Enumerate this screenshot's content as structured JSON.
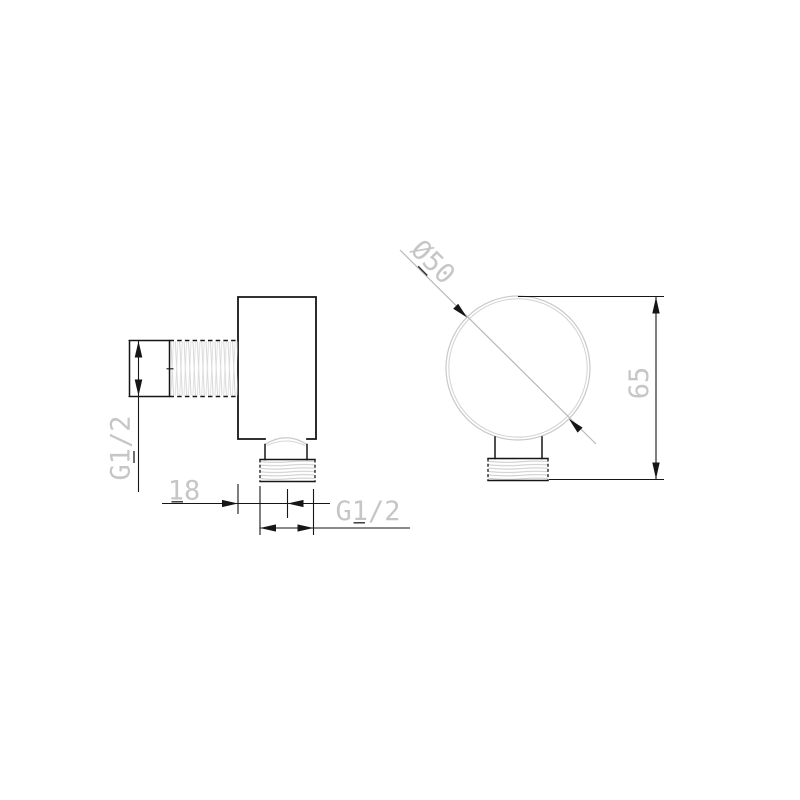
{
  "labels": {
    "side_thread": "G1/2",
    "offset_width": "18",
    "bottom_thread": "G1/2",
    "diameter": "Ø50",
    "height": "65"
  },
  "drawing": {
    "type": "technical-drawing",
    "views": [
      {
        "name": "side-view"
      },
      {
        "name": "front-view"
      }
    ],
    "dimension_values": [
      "G1/2",
      "18",
      "G1/2",
      "Ø50",
      "65"
    ]
  },
  "colors": {
    "outline": "#161616",
    "detail_gray": "#c9c9c9",
    "leader_gray": "#b9b9b9",
    "label_gray": "#c6c6c6",
    "underline_tick": "#303030",
    "background": "#ffffff"
  }
}
